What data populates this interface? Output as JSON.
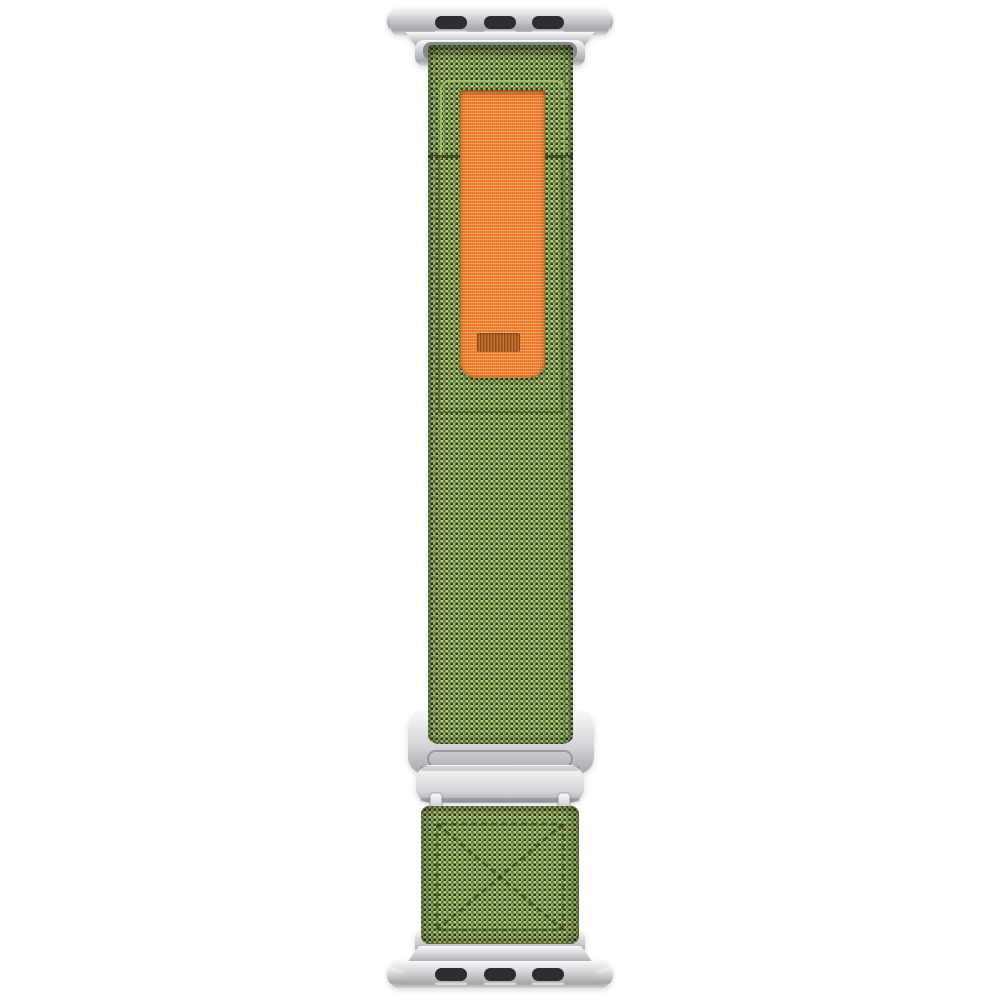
{
  "scene": {
    "description": "Product photo of a green woven trail-loop watch strap with an orange pull tab, silver lug adapters at both ends and a silver G-hook buckle, on a plain white background",
    "background": "#ffffff"
  },
  "parts": {
    "top_connector": "lug-adapter",
    "top_connector_slots": 3,
    "pull_tab": "orange-pull-loop",
    "buckle": "g-hook-buckle",
    "bottom_square": "x-box-stitched-end",
    "bottom_connector": "lug-adapter",
    "bottom_connector_slots": 3
  },
  "colors": {
    "bg": "#ffffff",
    "fabric-mid": "#7da24c",
    "fabric-light": "#b6d286",
    "fabric-light2": "#94b562",
    "fabric-dark": "#2e3a17",
    "fabric-dark2": "#5c6e30",
    "stitch-dark": "#24330c",
    "stitch-light": "#c8dfa0",
    "orange": "#f0812f",
    "orange-shade": "#d8691b",
    "orange-label": "#c0651c",
    "metal-hi": "#f8f8fa",
    "metal-mid": "#d4d5d8",
    "metal-low": "#a6a7ab",
    "metal-deep": "#87888c",
    "slot": "#2c2d30"
  }
}
